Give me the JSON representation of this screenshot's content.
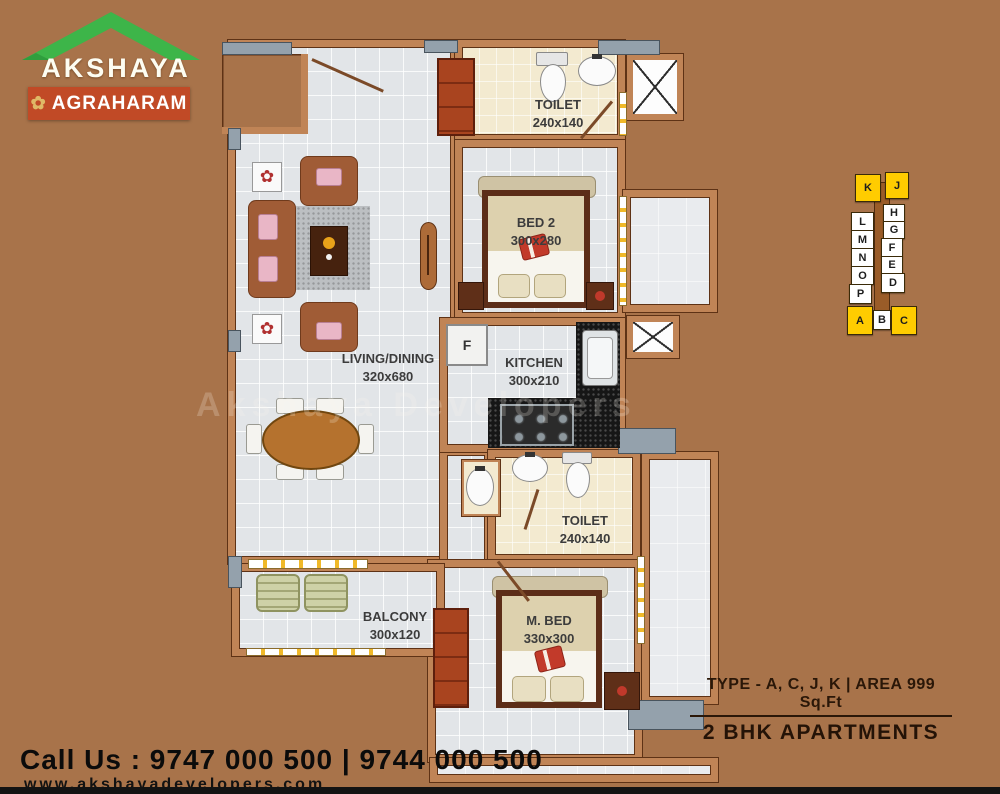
{
  "logo": {
    "brand": "AKSHAYA",
    "project": "AGRAHARAM",
    "ornament_glyph": "✿",
    "roof_color": "#3db549",
    "banner_color": "#c14a26"
  },
  "watermark": {
    "text": "Akshaya Developers"
  },
  "colors": {
    "background": "#a8734a",
    "wall": "#c08456",
    "highlight_yellow": "#ffcc00"
  },
  "rooms": {
    "toilet_top": {
      "name": "TOILET",
      "dim": "240x140"
    },
    "bed2": {
      "name": "BED 2",
      "dim": "300x280"
    },
    "living": {
      "name": "LIVING/DINING",
      "dim": "320x680"
    },
    "kitchen": {
      "name": "KITCHEN",
      "dim": "300x210"
    },
    "toilet_mid": {
      "name": "TOILET",
      "dim": "240x140"
    },
    "mbed": {
      "name": "M. BED",
      "dim": "330x300"
    },
    "balcony": {
      "name": "BALCONY",
      "dim": "300x120"
    },
    "fridge_label": "F"
  },
  "keyplan": {
    "units": [
      {
        "label": "K",
        "highlight": true
      },
      {
        "label": "J",
        "highlight": true
      },
      {
        "label": "H",
        "highlight": false
      },
      {
        "label": "G",
        "highlight": false
      },
      {
        "label": "F",
        "highlight": false
      },
      {
        "label": "E",
        "highlight": false
      },
      {
        "label": "D",
        "highlight": false
      },
      {
        "label": "L",
        "highlight": false
      },
      {
        "label": "M",
        "highlight": false
      },
      {
        "label": "N",
        "highlight": false
      },
      {
        "label": "O",
        "highlight": false
      },
      {
        "label": "P",
        "highlight": false
      },
      {
        "label": "A",
        "highlight": true
      },
      {
        "label": "B",
        "highlight": false
      },
      {
        "label": "C",
        "highlight": true
      }
    ]
  },
  "footer": {
    "call": "Call Us : 9747 000 500 | 9744 000 500",
    "website": "www.akshayadevelopers.com",
    "type_line": "TYPE - A, C, J, K | AREA 999 Sq.Ft",
    "bhk_line": "2 BHK APARTMENTS"
  }
}
